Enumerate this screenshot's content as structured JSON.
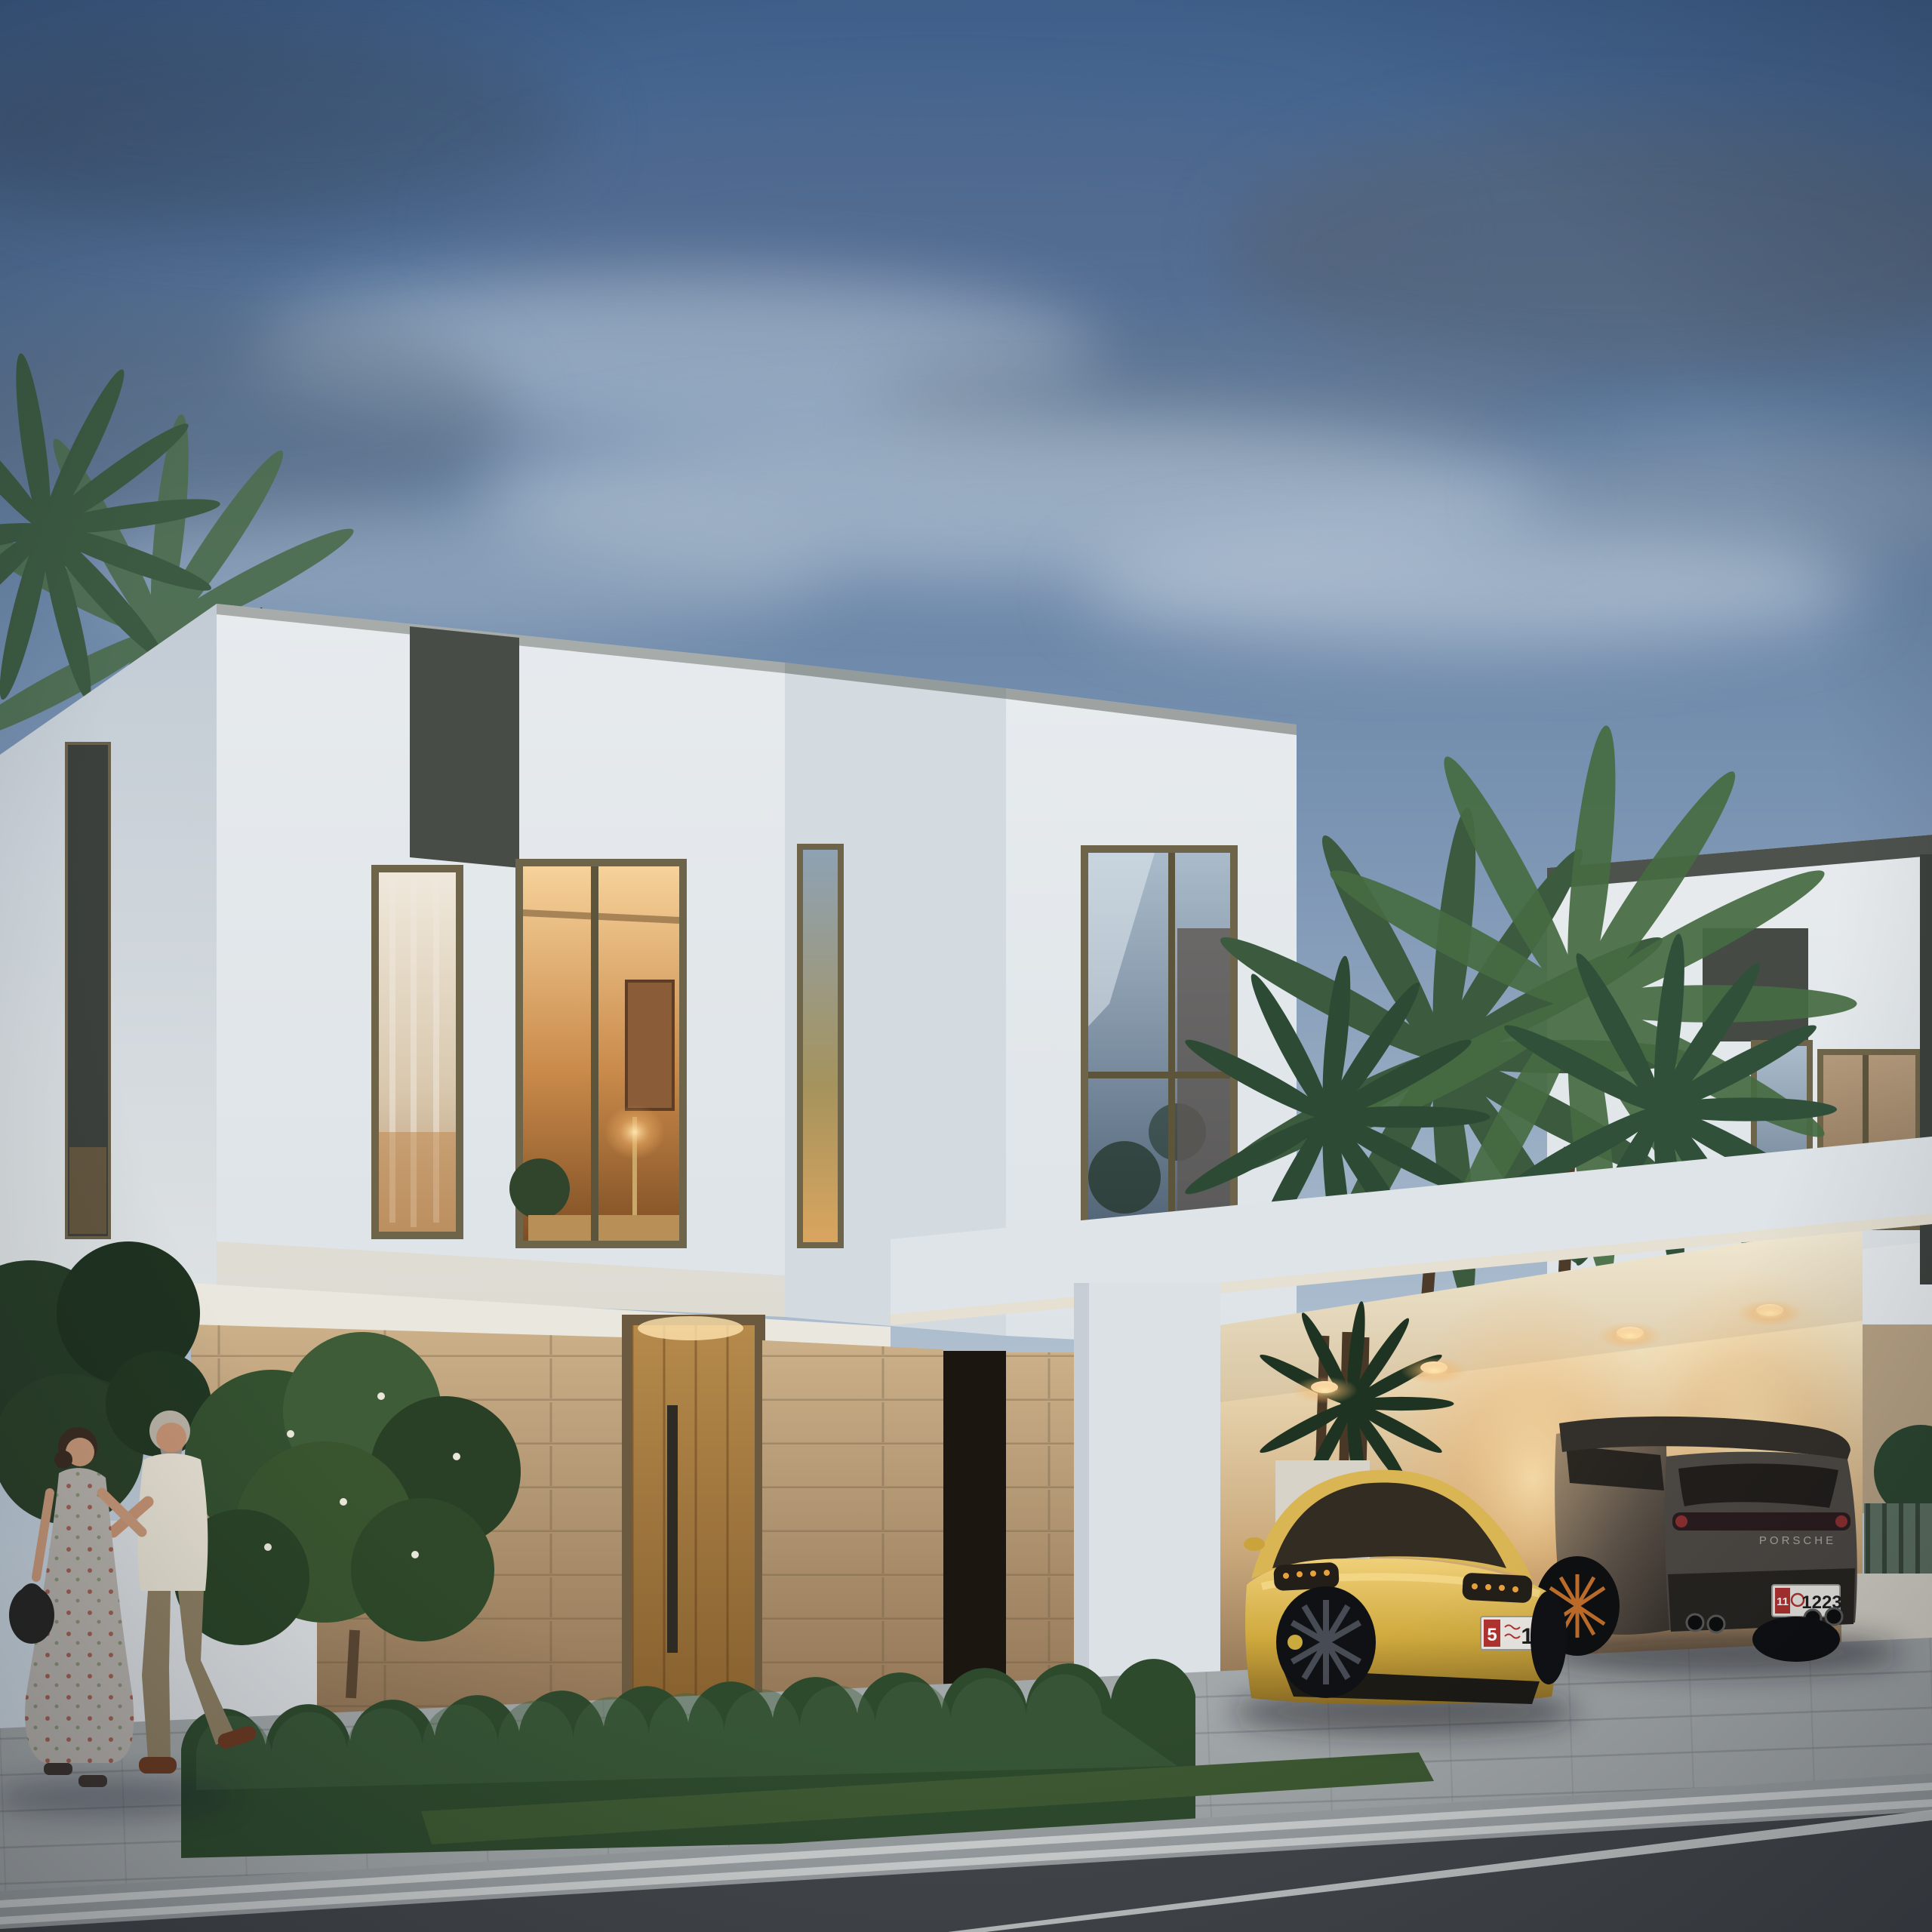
{
  "meta": {
    "type": "exterior architectural rendering",
    "time_of_day": "dusk",
    "description": "Modern white two-storey villas with warm interior lighting, stone-clad entrance, carport sheltering a yellow sports car and a dark SUV, palm trees, clipped hedges and a couple strolling along the sidewalk"
  },
  "palette": {
    "sky_top": "#3f5f8a",
    "sky_horizon": "#d8e0e6",
    "facade": "#e3e8ec",
    "facade_shadow": "#cdd5dc",
    "accent_panel": "#474c46",
    "window_frame_bronze": "#6e6449",
    "interior_glow": "#f2c27e",
    "stone": "#c9ad82",
    "door_wood": "#b08347",
    "hedge_green": "#2e4a2d",
    "palm_green": "#466c42",
    "asphalt": "#43474b",
    "paving": "#a2a7a9",
    "sports_car_yellow": "#cfa93d",
    "suv_grey": "#4c4843",
    "plate_red": "#b23330"
  },
  "buildings": {
    "villa_left": {
      "label": "left villa",
      "storeys": 2,
      "features": [
        "dark accent panel",
        "curtained tall window",
        "corner window with warm interior",
        "stone ground floor",
        "timber entrance door with long handle"
      ]
    },
    "villa_center_cube": {
      "label": "centre cube volume",
      "features": [
        "narrow slit window",
        "large picture window reflecting trees"
      ]
    },
    "villa_right": {
      "label": "right villa",
      "features": [
        "dark parapet cap",
        "accent panel",
        "curtained windows",
        "balcony parapet"
      ]
    },
    "carport": {
      "label": "carport",
      "recessed_downlights": 4,
      "back_wall_lighting": "warm"
    }
  },
  "vehicles": {
    "sports_car": {
      "kind": "yellow sports saloon",
      "body_color": "#cfa93d",
      "plate": {
        "category": "5",
        "number": "12"
      }
    },
    "suv": {
      "kind": "dark compact SUV",
      "badge_text": "PORSCHE",
      "body_color": "#4c4843",
      "plate": {
        "category": "11",
        "number": "1223"
      },
      "exhaust_tips": 4
    }
  },
  "people": {
    "count": 2,
    "woman": {
      "outfit": "sleeveless floral maxi dress",
      "accessory": "black handbag"
    },
    "man": {
      "outfit": "white linen shirt and khaki chinos",
      "hair": "grey"
    }
  },
  "landscape": [
    "palm fronds top left",
    "palm cluster over carport",
    "flowering shrub by entrance",
    "clipped hedge row",
    "grass verge"
  ],
  "street": {
    "lane_marking": "single white line",
    "gutter_lines": 2
  }
}
